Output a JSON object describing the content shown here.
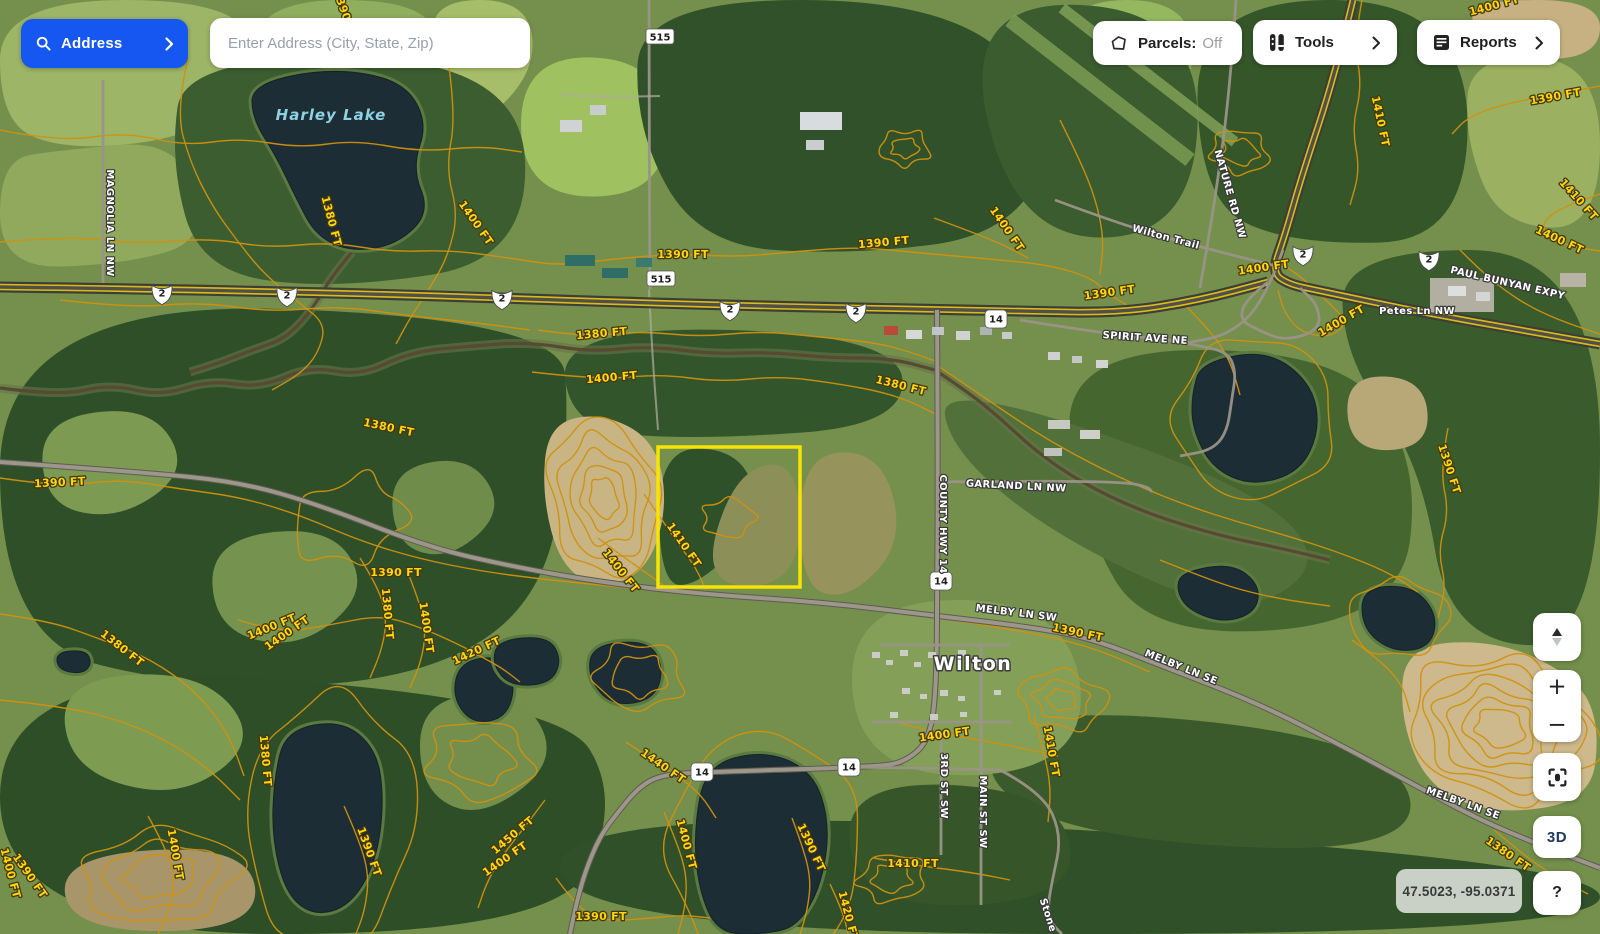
{
  "header": {
    "address_button_label": "Address",
    "search_placeholder": "Enter Address (City, State, Zip)",
    "parcels_label": "Parcels:",
    "parcels_state": "Off",
    "tools_label": "Tools",
    "reports_label": "Reports"
  },
  "controls": {
    "zoom_in": "+",
    "zoom_out": "−",
    "three_d": "3D",
    "help": "?"
  },
  "map": {
    "coordinates": "47.5023, -95.0371",
    "town_label": "Wilton",
    "lake_label": "Harley Lake",
    "parcel_color": "#f7e400",
    "highway_shields": {
      "us2": "2",
      "c515": "515",
      "c14": "14"
    },
    "street_labels": [
      "MAGNOLIA LN NW",
      "Wilton Trail",
      "NATURE RD NW",
      "SPIRIT AVE NE",
      "PAUL BUNYAN EXPY",
      "Petes Ln NW",
      "GARLAND LN NW",
      "COUNTY HWY 14",
      "MELBY LN SW",
      "MELBY LN SE",
      "MELBY LN SE",
      "3RD ST SW",
      "MAIN ST SW",
      "Stone"
    ],
    "contour_labels": [
      "1390 FT",
      "1380 FT",
      "1400 FT",
      "1390 FT",
      "1390 FT",
      "1400 FT",
      "1390 FT",
      "1400 FT",
      "1390 FT",
      "1400 FT",
      "1410 FT",
      "1410 FT",
      "1400 FT",
      "1400 FT",
      "1380 FT",
      "1400 FT",
      "1380 FT",
      "1390 FT",
      "1380 FT",
      "1390 FT",
      "1400 FT",
      "1380 FT",
      "1400 FT",
      "1410 FT",
      "1400 FT",
      "1390 FT",
      "1380 FT",
      "1400 FT",
      "1420 FT",
      "1380 FT",
      "1400 FT",
      "1390 FT",
      "1400 FT",
      "1390 FT",
      "1450 FT",
      "1400 FT",
      "1390 FT",
      "1440 FT",
      "1400 FT",
      "1390 FT",
      "1420 FT",
      "1400 FT",
      "1410 FT",
      "1410 FT",
      "1390 FT",
      "1380 FT"
    ]
  }
}
